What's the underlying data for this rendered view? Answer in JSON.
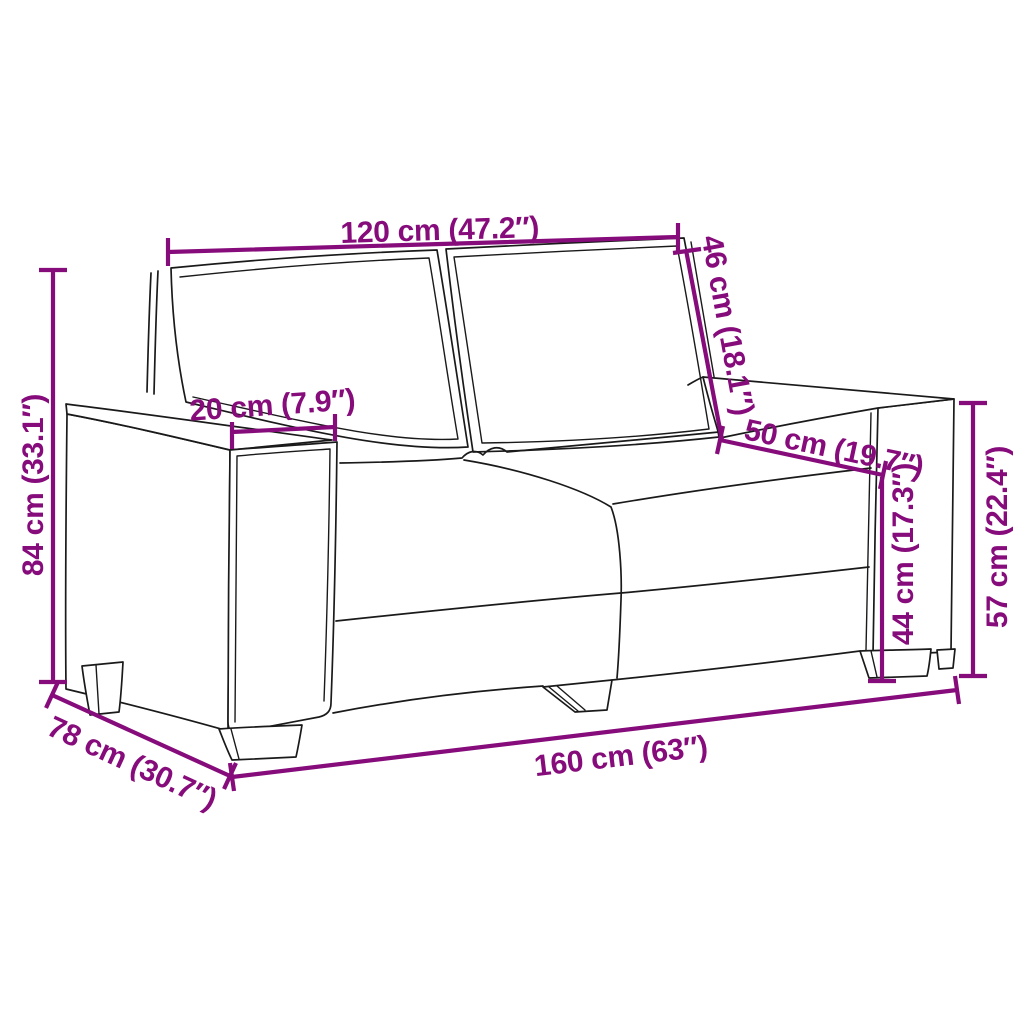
{
  "diagram": {
    "kind": "product-dimension-diagram",
    "subject": "two-seater-sofa",
    "colors": {
      "dimension_line": "#860B7B",
      "sofa_outline": "#1A1A1A",
      "background": "#FFFFFF"
    },
    "dimensions": {
      "backrest_width": {
        "label": "120 cm (47.2″)",
        "value_cm": "120",
        "value_in": "47.2"
      },
      "backrest_height": {
        "label": "46 cm (18.1″)",
        "value_cm": "46",
        "value_in": "18.1"
      },
      "armrest_width": {
        "label": "20 cm (7.9″)",
        "value_cm": "20",
        "value_in": "7.9"
      },
      "seat_depth": {
        "label": "50 cm (19.7″)",
        "value_cm": "50",
        "value_in": "19.7"
      },
      "overall_height": {
        "label": "84 cm (33.1″)",
        "value_cm": "84",
        "value_in": "33.1"
      },
      "seat_height": {
        "label": "44 cm (17.3″)",
        "value_cm": "44",
        "value_in": "17.3"
      },
      "armrest_height": {
        "label": "57 cm (22.4″)",
        "value_cm": "57",
        "value_in": "22.4"
      },
      "overall_depth": {
        "label": "78 cm (30.7″)",
        "value_cm": "78",
        "value_in": "30.7"
      },
      "overall_width": {
        "label": "160 cm (63″)",
        "value_cm": "160",
        "value_in": "63"
      }
    }
  }
}
